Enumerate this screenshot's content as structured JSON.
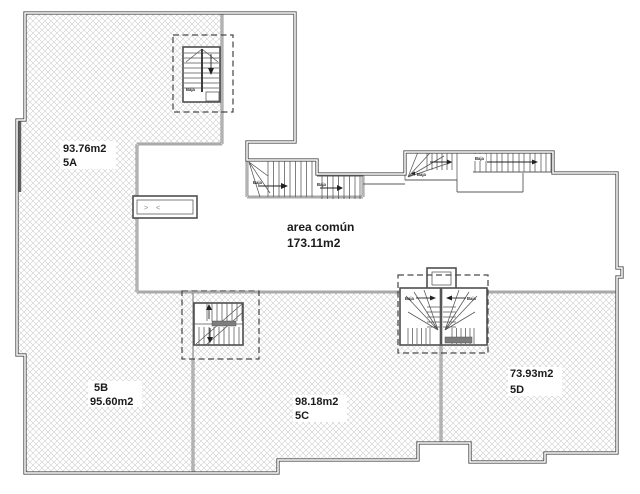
{
  "floorplan": {
    "units": [
      {
        "id": "5A",
        "area": "93.76m2"
      },
      {
        "id": "5B",
        "area": "95.60m2"
      },
      {
        "id": "5C",
        "area": "98.18m2"
      },
      {
        "id": "5D",
        "area": "73.93m2"
      }
    ],
    "common_area": {
      "name": "area común",
      "area": "173.11m2"
    },
    "stair_direction_label": "Baja",
    "door_symbol_left": ">",
    "door_symbol_right": "<",
    "colors": {
      "wall": "#4d4d4d",
      "hatch": "#cccccc",
      "text": "#1b1b1b",
      "background": "#ffffff"
    }
  }
}
